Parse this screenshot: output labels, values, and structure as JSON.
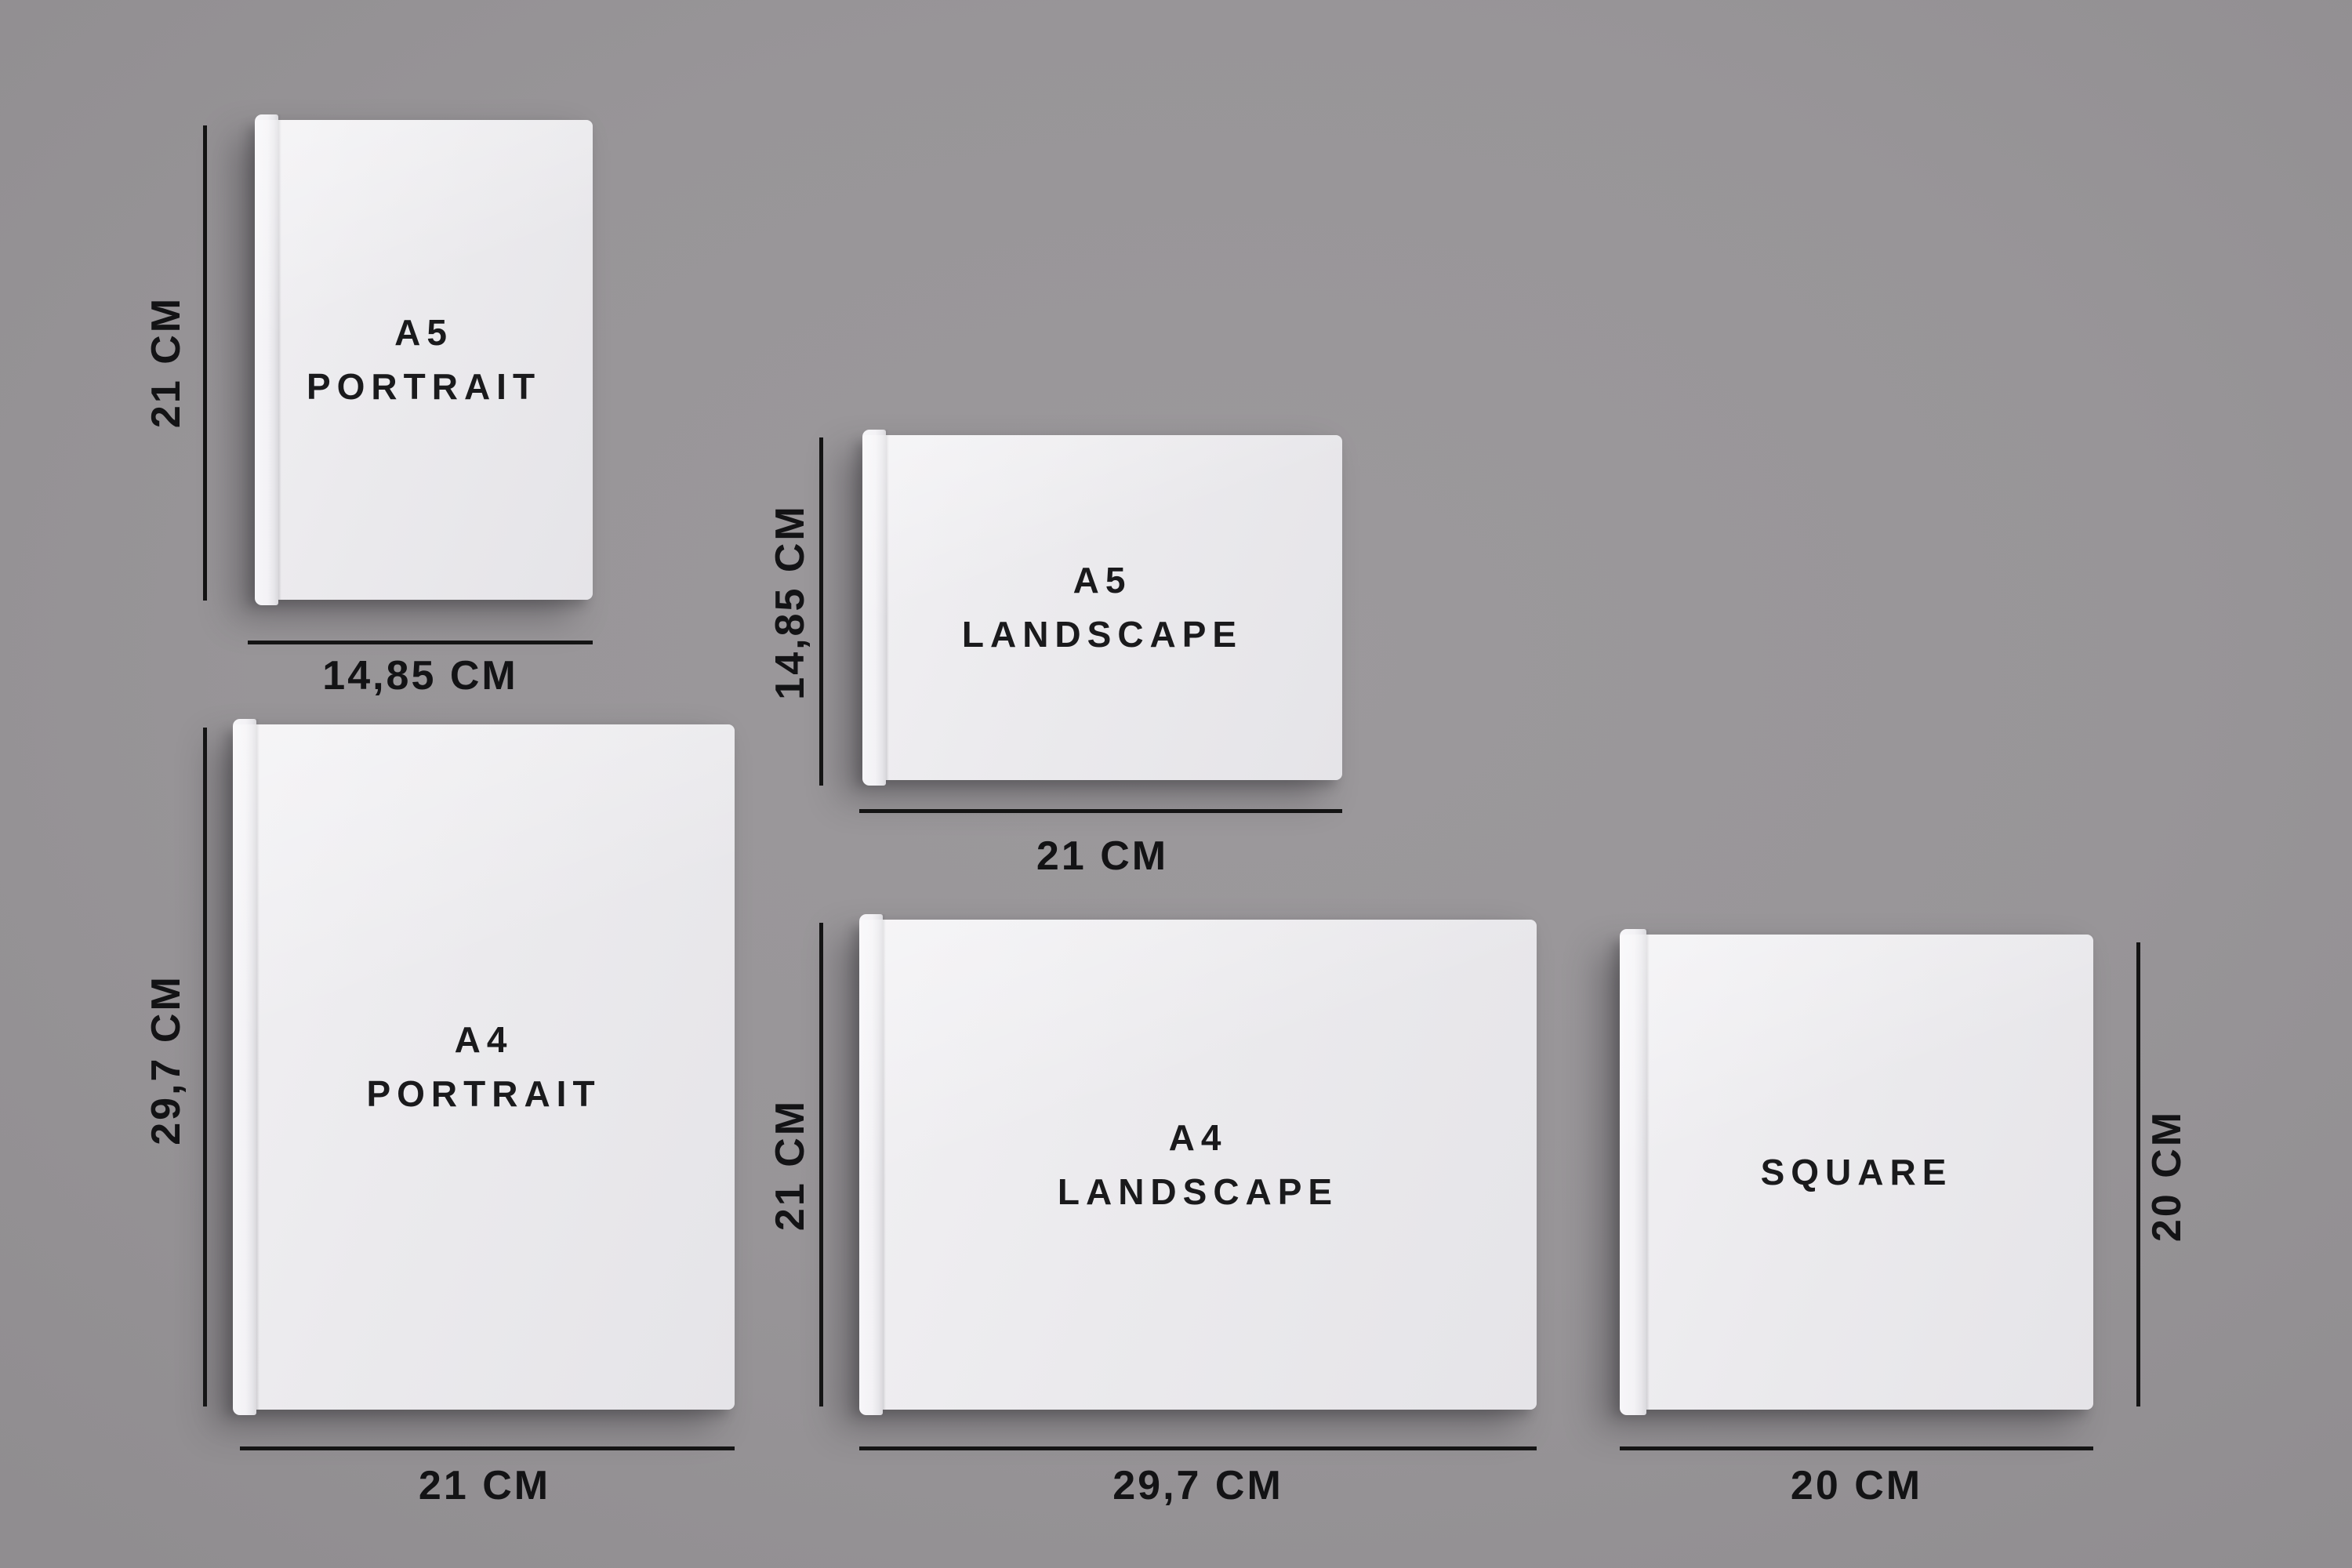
{
  "page": {
    "background_color": "#989598",
    "dimension_line_color": "#141414",
    "label_color": "#131315",
    "book_face_color": "#ebeaed",
    "book_spine_color": "#f3f2f5"
  },
  "books": [
    {
      "name": "A5 Portrait",
      "title_lines": [
        "A5",
        "PORTRAIT"
      ],
      "height_label": "21 CM",
      "width_label": "14,85 CM"
    },
    {
      "name": "A5 Landscape",
      "title_lines": [
        "A5",
        "LANDSCAPE"
      ],
      "height_label": "14,85 CM",
      "width_label": "21 CM"
    },
    {
      "name": "A4 Portrait",
      "title_lines": [
        "A4",
        "PORTRAIT"
      ],
      "height_label": "29,7 CM",
      "width_label": "21 CM"
    },
    {
      "name": "A4 Landscape",
      "title_lines": [
        "A4",
        "LANDSCAPE"
      ],
      "height_label": "21 CM",
      "width_label": "29,7 CM"
    },
    {
      "name": "Square",
      "title_lines": [
        "SQUARE"
      ],
      "height_label": "20 CM",
      "width_label": "20 CM"
    }
  ]
}
